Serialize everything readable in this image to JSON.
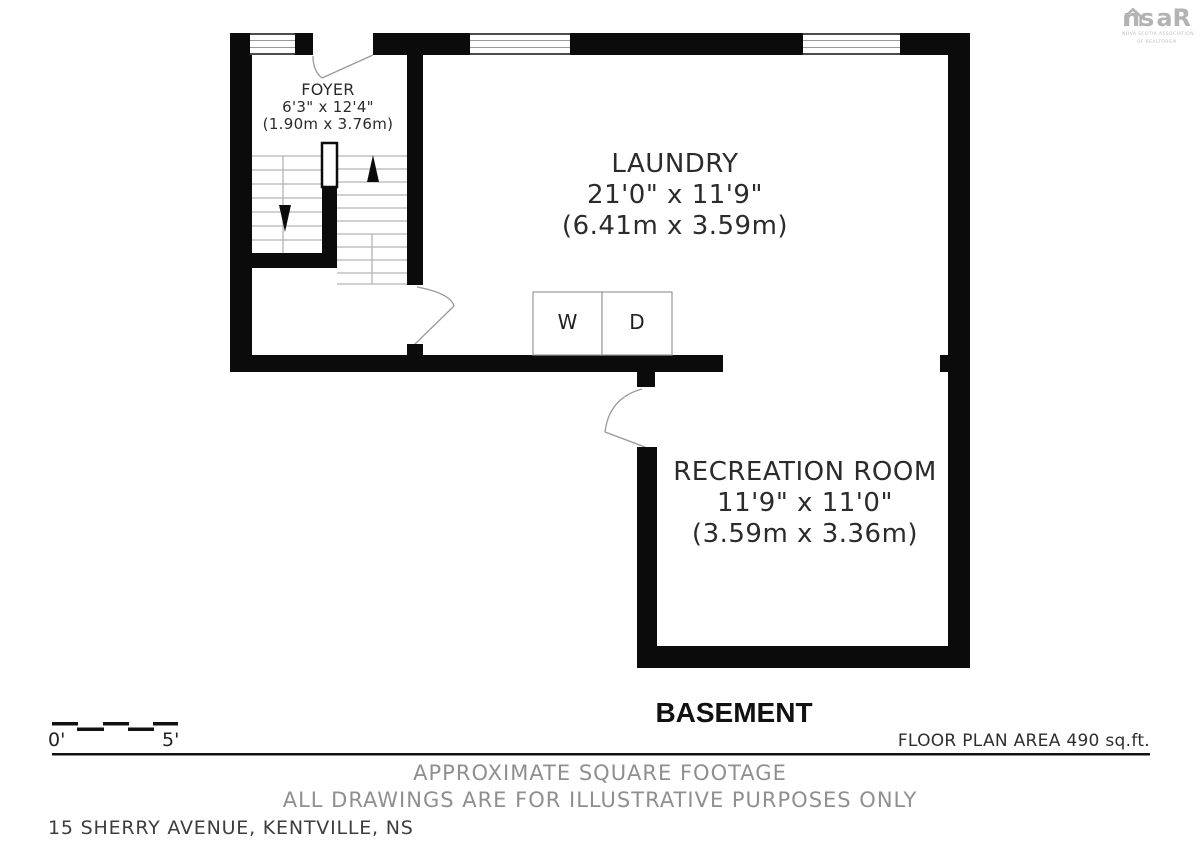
{
  "logo": {
    "prefix": "ns",
    "suffix": "aR",
    "tagline1": "NOVA SCOTIA ASSOCIATION",
    "tagline2": "OF REALTORS®"
  },
  "rooms": {
    "foyer": {
      "name": "FOYER",
      "imperial": "6'3\" x 12'4\"",
      "metric": "(1.90m x 3.76m)"
    },
    "laundry": {
      "name": "LAUNDRY",
      "imperial": "21'0\" x 11'9\"",
      "metric": "(6.41m x 3.59m)"
    },
    "recreation": {
      "name": "RECREATION ROOM",
      "imperial": "11'9\" x 11'0\"",
      "metric": "(3.59m x 3.36m)"
    }
  },
  "appliances": {
    "washer": "W",
    "dryer": "D"
  },
  "floor_title": "BASEMENT",
  "floor_area": "FLOOR PLAN AREA 490 sq.ft.",
  "scale_bar": {
    "start": "0'",
    "end": "5'"
  },
  "disclaimers": {
    "line1": "APPROXIMATE SQUARE FOOTAGE",
    "line2": "ALL DRAWINGS ARE FOR ILLUSTRATIVE PURPOSES ONLY"
  },
  "address": "15 SHERRY AVENUE, KENTVILLE, NS",
  "colors": {
    "wall": "#0b0b0b",
    "disclaimer_gray": "#8f8f8f",
    "logo_gray": "#b3b3b3"
  }
}
